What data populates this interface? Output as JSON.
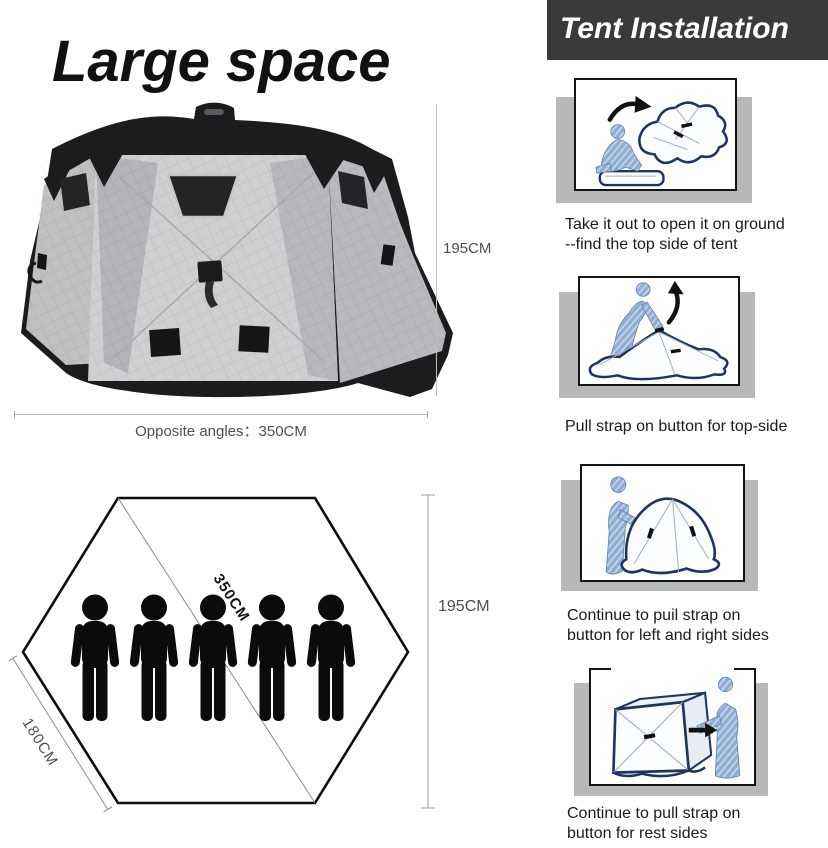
{
  "title": "Large space",
  "tent_diagram": {
    "height_label": "195CM",
    "width_label": "Opposite angles：350CM"
  },
  "floor_plan": {
    "height_label": "195CM",
    "diagonal_label": "350CM",
    "side_label": "180CM",
    "person_count": 5
  },
  "installation": {
    "header": "Tent Installation",
    "steps": [
      {
        "lines": [
          "Take it out to open it on ground",
          "--find the top side of tent"
        ]
      },
      {
        "lines": [
          "Pull strap on button for top-side"
        ]
      },
      {
        "lines": [
          "Continue to puil strap on",
          "button for left and right sides"
        ]
      },
      {
        "lines": [
          "Continue to pull strap on",
          "button for rest sides"
        ]
      }
    ]
  },
  "colors": {
    "header_bg": "#3a3a3c",
    "header_text": "#ffffff",
    "step_slab_gray": "#b7b8ba",
    "frame_border": "#141414",
    "measure_text": "#4f4f4f",
    "measure_line": "#bfbfbf",
    "hexagon_stroke": "#0d0d0d",
    "person_black": "#0b0b0b",
    "illustration_navy": "#1e3560",
    "illustration_person_blue": "#8fadd3",
    "tent_gray_light": "#cfd0d2",
    "tent_gray_mid": "#bfc0c2",
    "tent_black": "#1b1c1e"
  }
}
